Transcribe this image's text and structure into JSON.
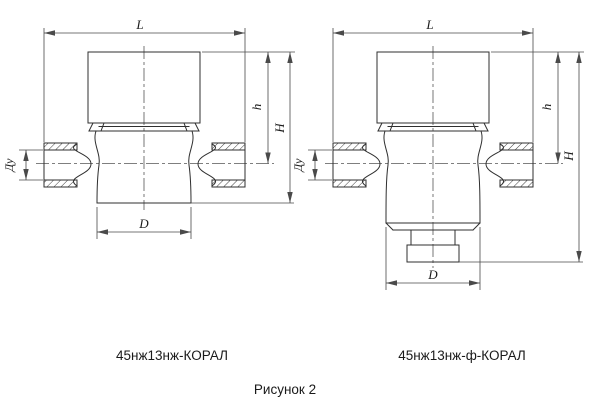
{
  "drawing": {
    "caption": "Рисунок 2",
    "views": {
      "left": {
        "label": "45нж13нж-КОРАЛ",
        "dims": {
          "length": "L",
          "bonnet_height": "h",
          "total_height": "H",
          "bore": "Ду",
          "bottom_diameter": "D"
        }
      },
      "right": {
        "label": "45нж13нж-ф-КОРАЛ",
        "dims": {
          "length": "L",
          "bonnet_height": "h",
          "total_height": "H",
          "bore": "Ду",
          "bottom_diameter": "D"
        }
      }
    }
  },
  "colors": {
    "background": "#ffffff",
    "outline": "#2f2f2f",
    "dimension_lines": "#4a4a4a",
    "text": "#1a1a1a"
  }
}
